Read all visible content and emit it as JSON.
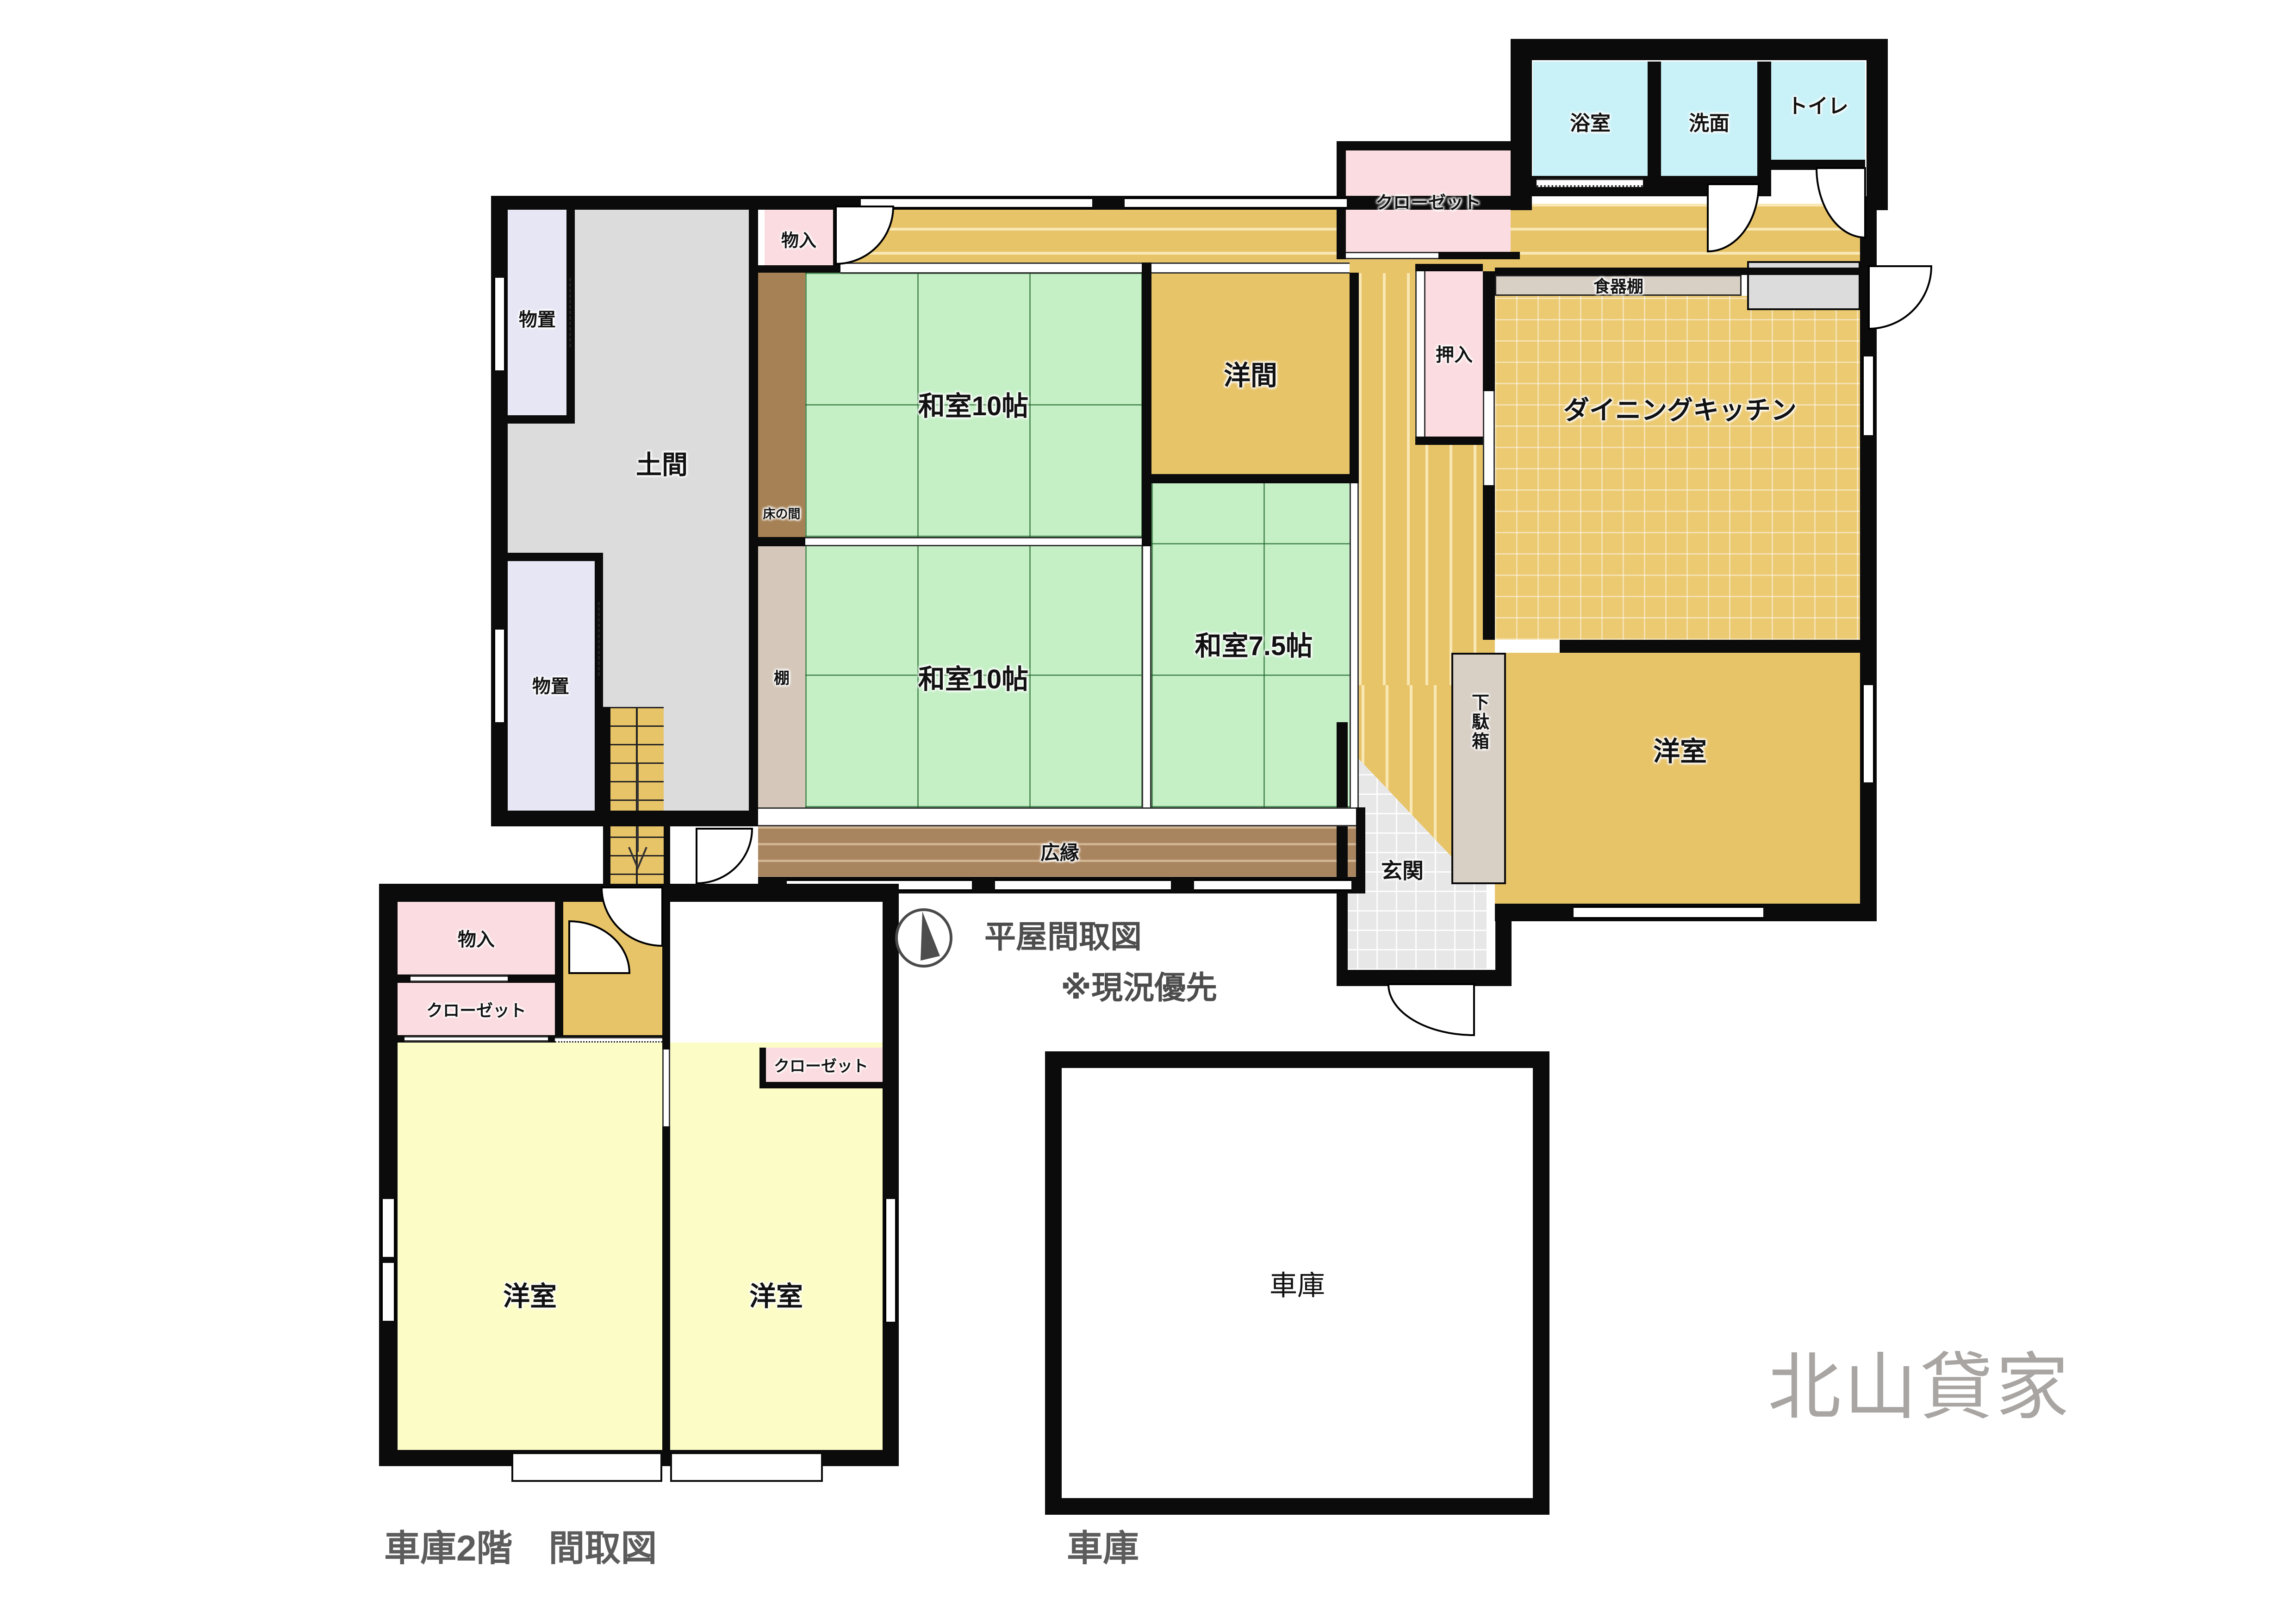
{
  "titles": {
    "floor_plan": "平屋間取図",
    "note": "※現況優先",
    "garage_2f_caption": "車庫2階　間取図",
    "garage_caption": "車庫",
    "watermark": "北山貸家"
  },
  "main_house": {
    "monooki_upper": "物置",
    "monooki_lower": "物置",
    "doma": "土間",
    "mononyu": "物入",
    "tokonoma": "床の間",
    "washitsu10_top": "和室10帖",
    "washitsu10_bottom": "和室10帖",
    "tana": "棚",
    "hiroen": "広縁",
    "youma": "洋間",
    "washitsu75": "和室7.5帖",
    "oshiire": "押入",
    "closet": "クローゼット",
    "yokushitsu": "浴室",
    "senmen": "洗面",
    "toilet": "トイレ",
    "shokkidana": "食器棚",
    "dining_kitchen": "ダイニングキッチン",
    "youshitsu": "洋室",
    "getabako": "下駄箱",
    "genkan": "玄関"
  },
  "garage_2f": {
    "mononyu": "物入",
    "closet": "クローゼット",
    "youshitsu_left": "洋室",
    "youshitsu_right": "洋室",
    "closet_small": "クローゼット"
  },
  "garage": {
    "label": "車庫"
  },
  "colors": {
    "tatami_green": "#c5f0c6",
    "wood_tan": "#e8c469",
    "hiroen_brown": "#a9855f",
    "tokonoma_brown": "#a58155",
    "tana_taupe": "#d5c8ba",
    "cabinet_taupe": "#d8cfc5",
    "closet_pink": "#fbdce0",
    "storage_lavender": "#e6e6f5",
    "doma_gray": "#dcdcdc",
    "bath_cyan": "#c9f2f8",
    "room_yellow": "#fcfcc6",
    "wall_black": "#0b0b0b",
    "title_gray": "#4d4d4d",
    "watermark_gray": "#a8a5a3"
  }
}
